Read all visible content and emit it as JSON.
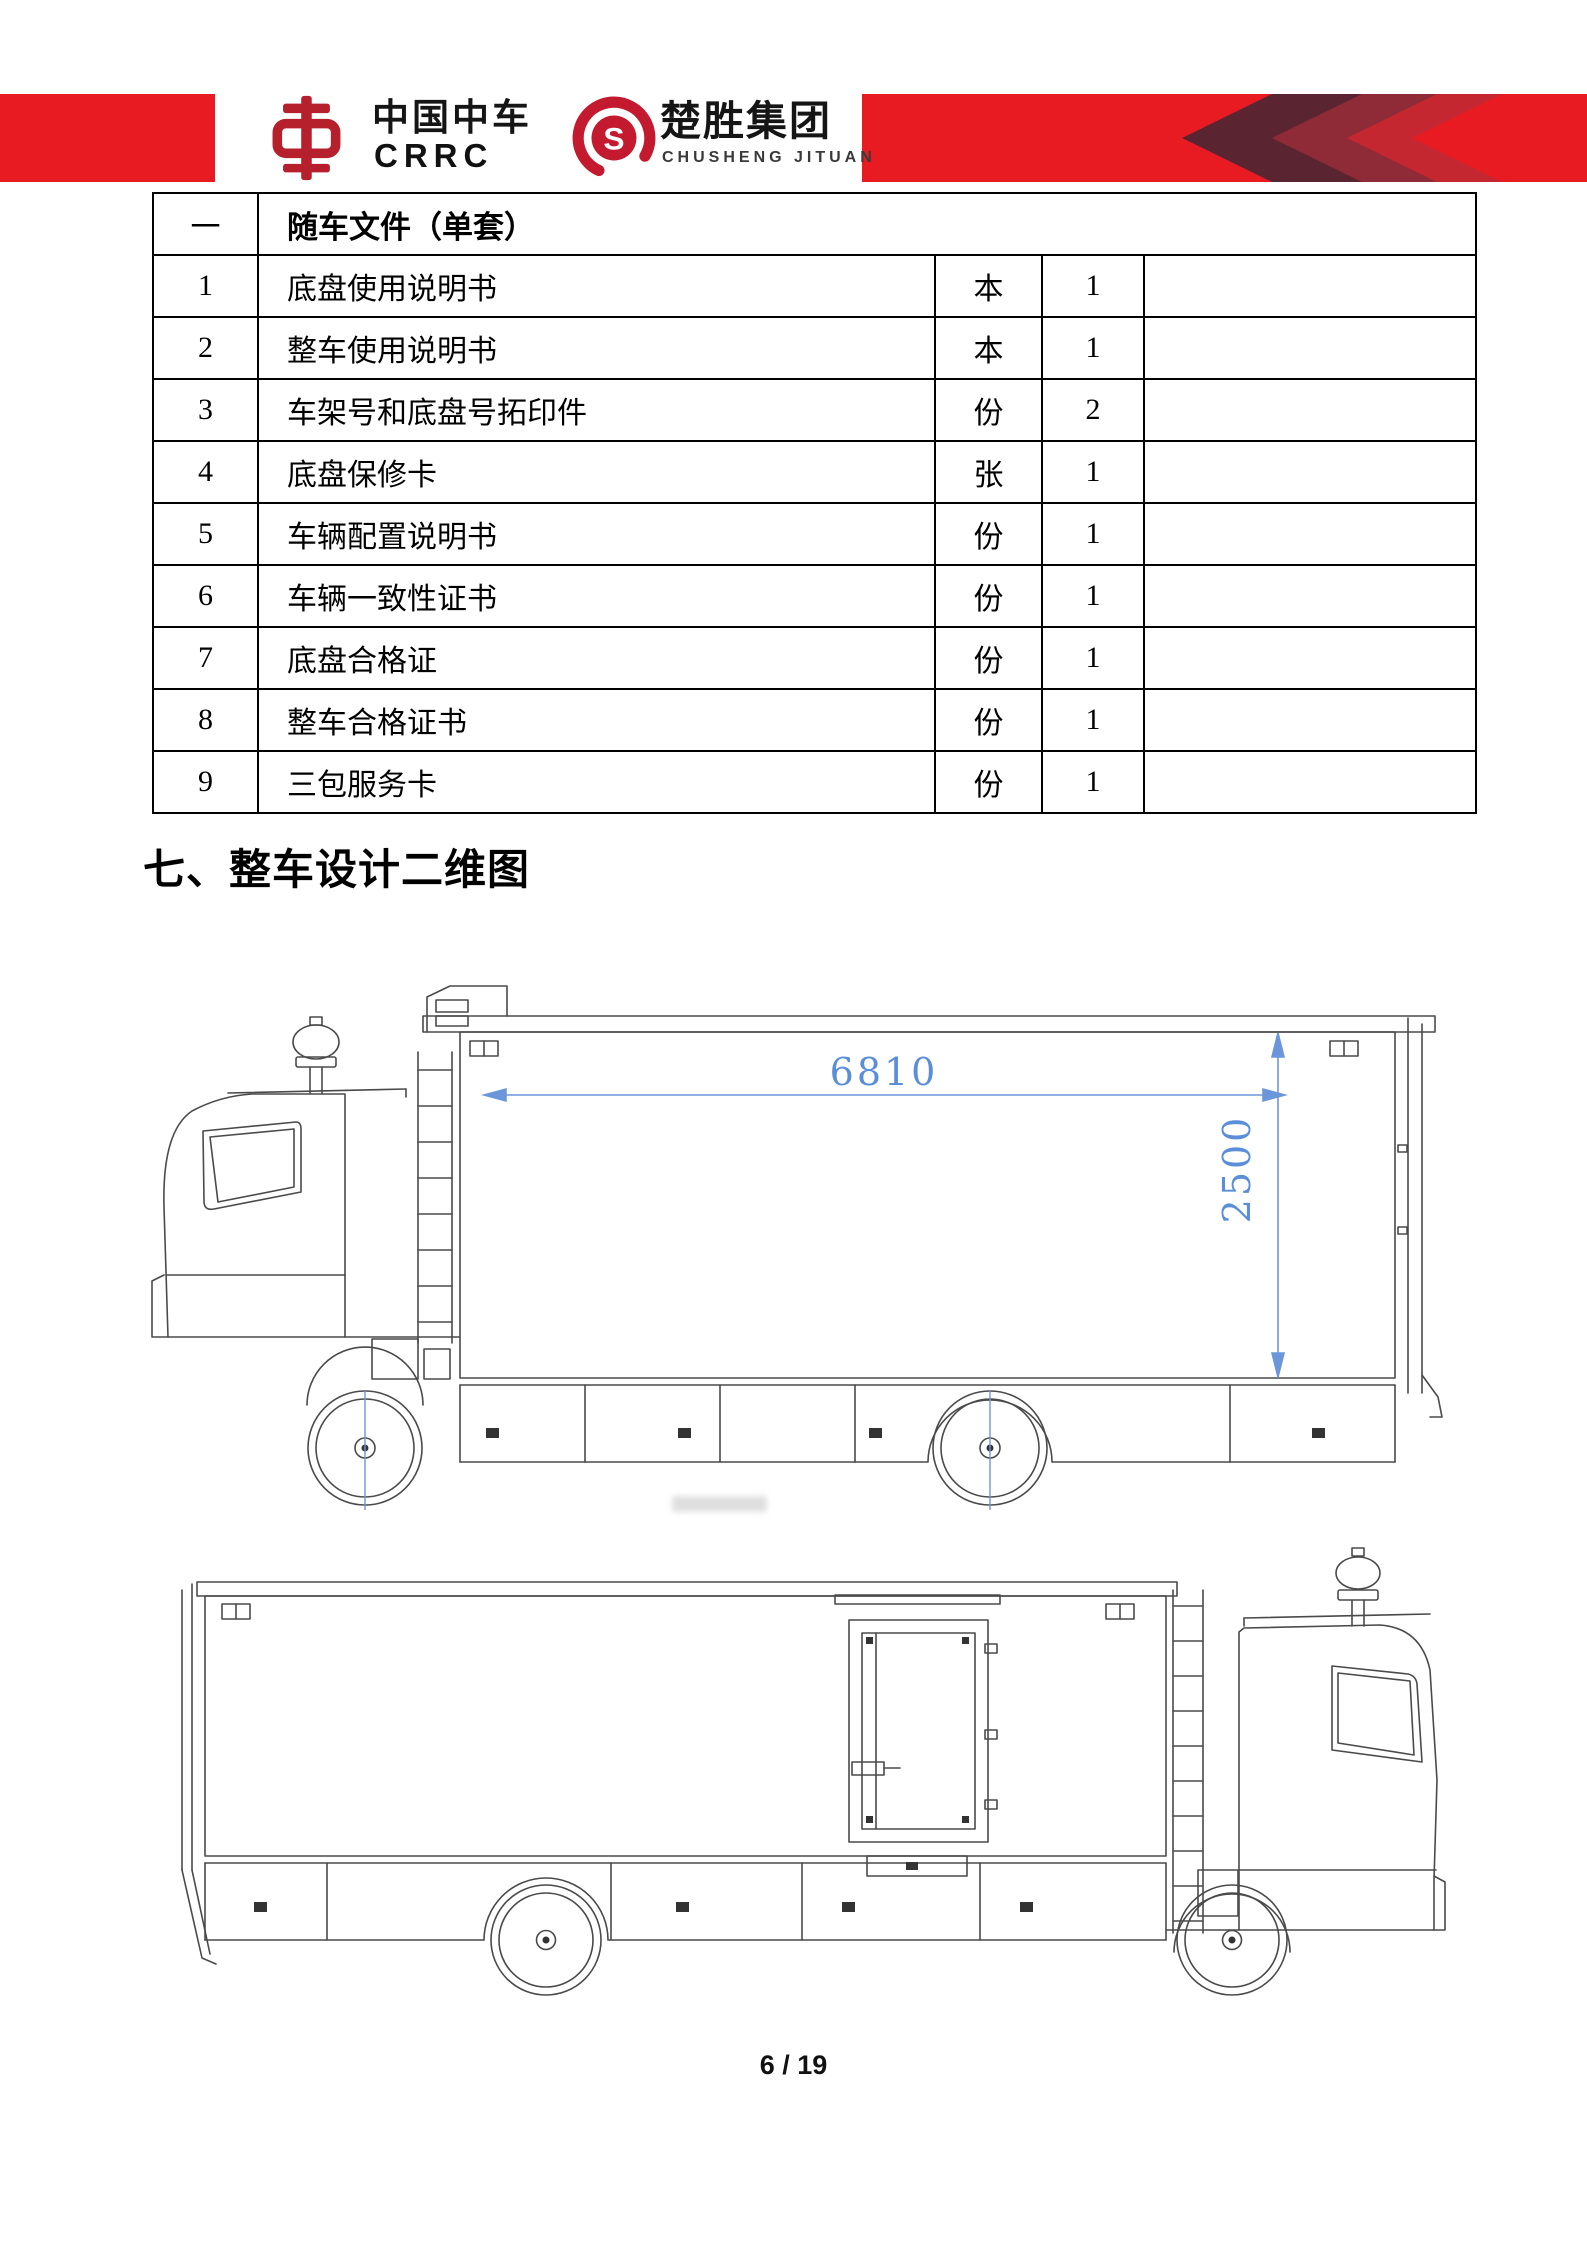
{
  "header": {
    "crrc": {
      "zh": "中国中车",
      "en": "CRRC"
    },
    "chusheng": {
      "zh": "楚胜集团",
      "en": "CHUSHENG JITUAN",
      "monogram": "S"
    },
    "colors": {
      "bar_red": "#e81b23",
      "chevron_dark": "#5a2530",
      "chevron_mid": "#8e2b36",
      "chevron_crimson": "#c52731",
      "crrc_logo_red": "#b5202c",
      "chusheng_logo_red": "#c41a2f"
    }
  },
  "table": {
    "section_index": "一",
    "section_title": "随车文件（单套）",
    "rows": [
      {
        "no": "1",
        "name": "底盘使用说明书",
        "unit": "本",
        "qty": "1",
        "remark": ""
      },
      {
        "no": "2",
        "name": "整车使用说明书",
        "unit": "本",
        "qty": "1",
        "remark": ""
      },
      {
        "no": "3",
        "name": "车架号和底盘号拓印件",
        "unit": "份",
        "qty": "2",
        "remark": ""
      },
      {
        "no": "4",
        "name": "底盘保修卡",
        "unit": "张",
        "qty": "1",
        "remark": ""
      },
      {
        "no": "5",
        "name": "车辆配置说明书",
        "unit": "份",
        "qty": "1",
        "remark": ""
      },
      {
        "no": "6",
        "name": "车辆一致性证书",
        "unit": "份",
        "qty": "1",
        "remark": ""
      },
      {
        "no": "7",
        "name": "底盘合格证",
        "unit": "份",
        "qty": "1",
        "remark": ""
      },
      {
        "no": "8",
        "name": "整车合格证书",
        "unit": "份",
        "qty": "1",
        "remark": ""
      },
      {
        "no": "9",
        "name": "三包服务卡",
        "unit": "份",
        "qty": "1",
        "remark": ""
      }
    ]
  },
  "section_heading": "七、整车设计二维图",
  "drawings": {
    "dimension_color": "#5b8ed8",
    "side_view_cab_left": {
      "length_mm": "6810",
      "height_mm": "2500"
    },
    "side_view_cab_right": {}
  },
  "footer": {
    "page_number": "6 / 19"
  }
}
